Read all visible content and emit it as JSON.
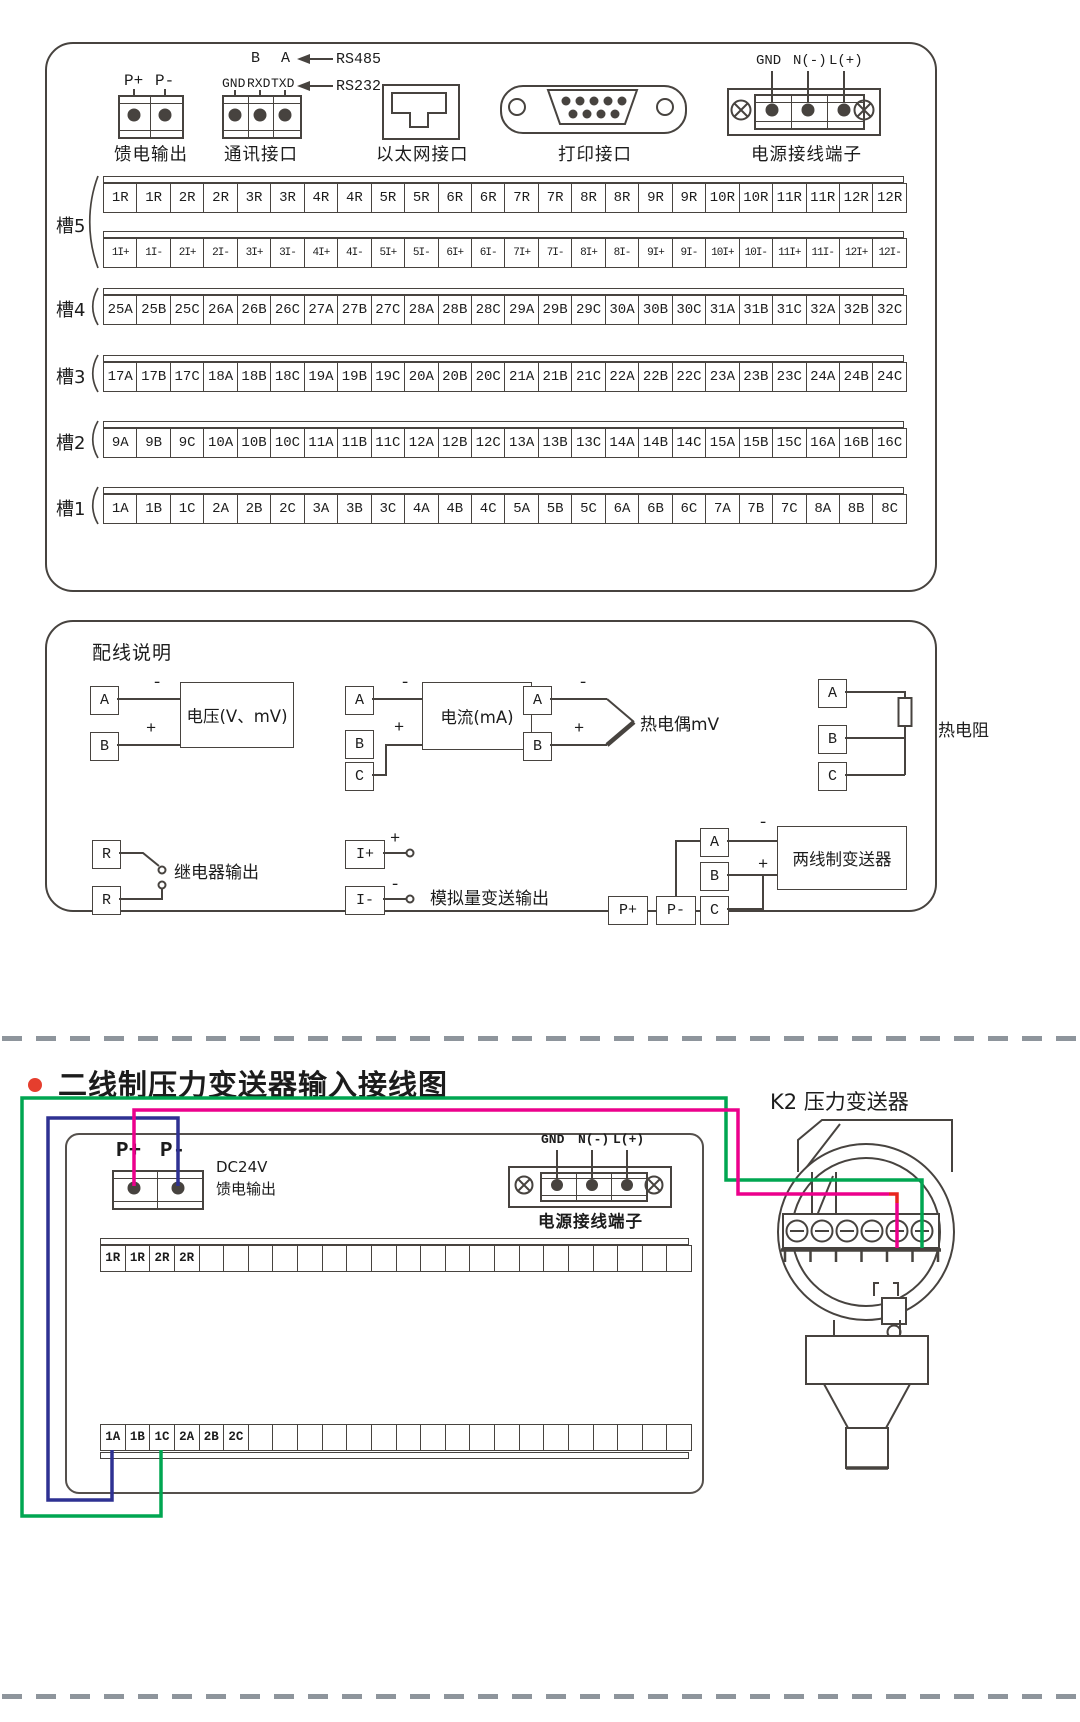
{
  "signs": {
    "minus": "-",
    "plus": "+"
  },
  "colors": {
    "line": "#47433f",
    "wire_green": "#00A651",
    "wire_magenta": "#EC008C",
    "wire_blue": "#2E3192",
    "wire_red": "#E8251F",
    "bullet_red": "#E53E2E"
  },
  "top_panel": {
    "connectors": {
      "feed": {
        "caption": "馈电输出",
        "pins": [
          "P+",
          "P-"
        ]
      },
      "comm": {
        "caption": "通讯接口",
        "pins": [
          "GND",
          "RXD",
          "TXD"
        ],
        "rs485_pins": [
          "B",
          "A"
        ],
        "rs485_label": "RS485",
        "rs232_label": "RS232"
      },
      "ethernet": {
        "caption": "以太网接口"
      },
      "printer": {
        "caption": "打印接口"
      },
      "power": {
        "caption": "电源接线端子",
        "pins": [
          "GND",
          "N(-)",
          "L(+)"
        ]
      }
    },
    "slots": [
      {
        "label": "槽5",
        "row_r": [
          "1R",
          "1R",
          "2R",
          "2R",
          "3R",
          "3R",
          "4R",
          "4R",
          "5R",
          "5R",
          "6R",
          "6R",
          "7R",
          "7R",
          "8R",
          "8R",
          "9R",
          "9R",
          "10R",
          "10R",
          "11R",
          "11R",
          "12R",
          "12R"
        ],
        "row_i": [
          "1I+",
          "1I-",
          "2I+",
          "2I-",
          "3I+",
          "3I-",
          "4I+",
          "4I-",
          "5I+",
          "5I-",
          "6I+",
          "6I-",
          "7I+",
          "7I-",
          "8I+",
          "8I-",
          "9I+",
          "9I-",
          "10I+",
          "10I-",
          "11I+",
          "11I-",
          "12I+",
          "12I-"
        ]
      },
      {
        "label": "槽4",
        "cells": [
          "25A",
          "25B",
          "25C",
          "26A",
          "26B",
          "26C",
          "27A",
          "27B",
          "27C",
          "28A",
          "28B",
          "28C",
          "29A",
          "29B",
          "29C",
          "30A",
          "30B",
          "30C",
          "31A",
          "31B",
          "31C",
          "32A",
          "32B",
          "32C"
        ]
      },
      {
        "label": "槽3",
        "cells": [
          "17A",
          "17B",
          "17C",
          "18A",
          "18B",
          "18C",
          "19A",
          "19B",
          "19C",
          "20A",
          "20B",
          "20C",
          "21A",
          "21B",
          "21C",
          "22A",
          "22B",
          "22C",
          "23A",
          "23B",
          "23C",
          "24A",
          "24B",
          "24C"
        ]
      },
      {
        "label": "槽2",
        "cells": [
          "9A",
          "9B",
          "9C",
          "10A",
          "10B",
          "10C",
          "11A",
          "11B",
          "11C",
          "12A",
          "12B",
          "12C",
          "13A",
          "13B",
          "13C",
          "14A",
          "14B",
          "14C",
          "15A",
          "15B",
          "15C",
          "16A",
          "16B",
          "16C"
        ]
      },
      {
        "label": "槽1",
        "cells": [
          "1A",
          "1B",
          "1C",
          "2A",
          "2B",
          "2C",
          "3A",
          "3B",
          "3C",
          "4A",
          "4B",
          "4C",
          "5A",
          "5B",
          "5C",
          "6A",
          "6B",
          "6C",
          "7A",
          "7B",
          "7C",
          "8A",
          "8B",
          "8C"
        ]
      }
    ]
  },
  "wiring_guide": {
    "title": "配线说明",
    "voltage": {
      "label": "电压(V、mV)",
      "terminals": [
        "A",
        "B"
      ]
    },
    "current": {
      "label": "电流(mA)",
      "terminals": [
        "A",
        "B",
        "C"
      ]
    },
    "thermocouple": {
      "label": "热电偶mV",
      "terminals": [
        "A",
        "B"
      ]
    },
    "rtd": {
      "label": "热电阻",
      "terminals": [
        "A",
        "B",
        "C"
      ]
    },
    "relay": {
      "label": "继电器输出",
      "terminals": [
        "R",
        "R"
      ]
    },
    "analog_out": {
      "label": "模拟量变送输出",
      "terminals": [
        "I+",
        "I-"
      ]
    },
    "two_wire": {
      "label": "两线制变送器",
      "terminals": [
        "A",
        "B",
        "C"
      ],
      "feed_terminals": [
        "P+",
        "P-"
      ]
    }
  },
  "bottom_diagram": {
    "title": "二线制压力变送器输入接线图",
    "transmitter_label": "K2 压力变送器",
    "feed": {
      "pins": [
        "P+",
        "P-"
      ],
      "caption_line1": "DC24V",
      "caption_line2": "馈电输出"
    },
    "power": {
      "pins": [
        "GND",
        "N(-)",
        "L(+)"
      ],
      "caption": "电源接线端子"
    },
    "strip_top": {
      "cells": [
        "1R",
        "1R",
        "2R",
        "2R",
        "",
        "",
        "",
        "",
        "",
        "",
        "",
        "",
        "",
        "",
        "",
        "",
        "",
        "",
        "",
        "",
        "",
        "",
        "",
        ""
      ]
    },
    "strip_bottom": {
      "cells": [
        "1A",
        "1B",
        "1C",
        "2A",
        "2B",
        "2C",
        "",
        "",
        "",
        "",
        "",
        "",
        "",
        "",
        "",
        "",
        "",
        "",
        "",
        "",
        "",
        "",
        "",
        ""
      ]
    },
    "transmitter_terminals": {
      "p1": "+",
      "m1": "-",
      "p2": "+",
      "m2": "-",
      "a": "A",
      "b": "B",
      "a2": "A"
    }
  }
}
